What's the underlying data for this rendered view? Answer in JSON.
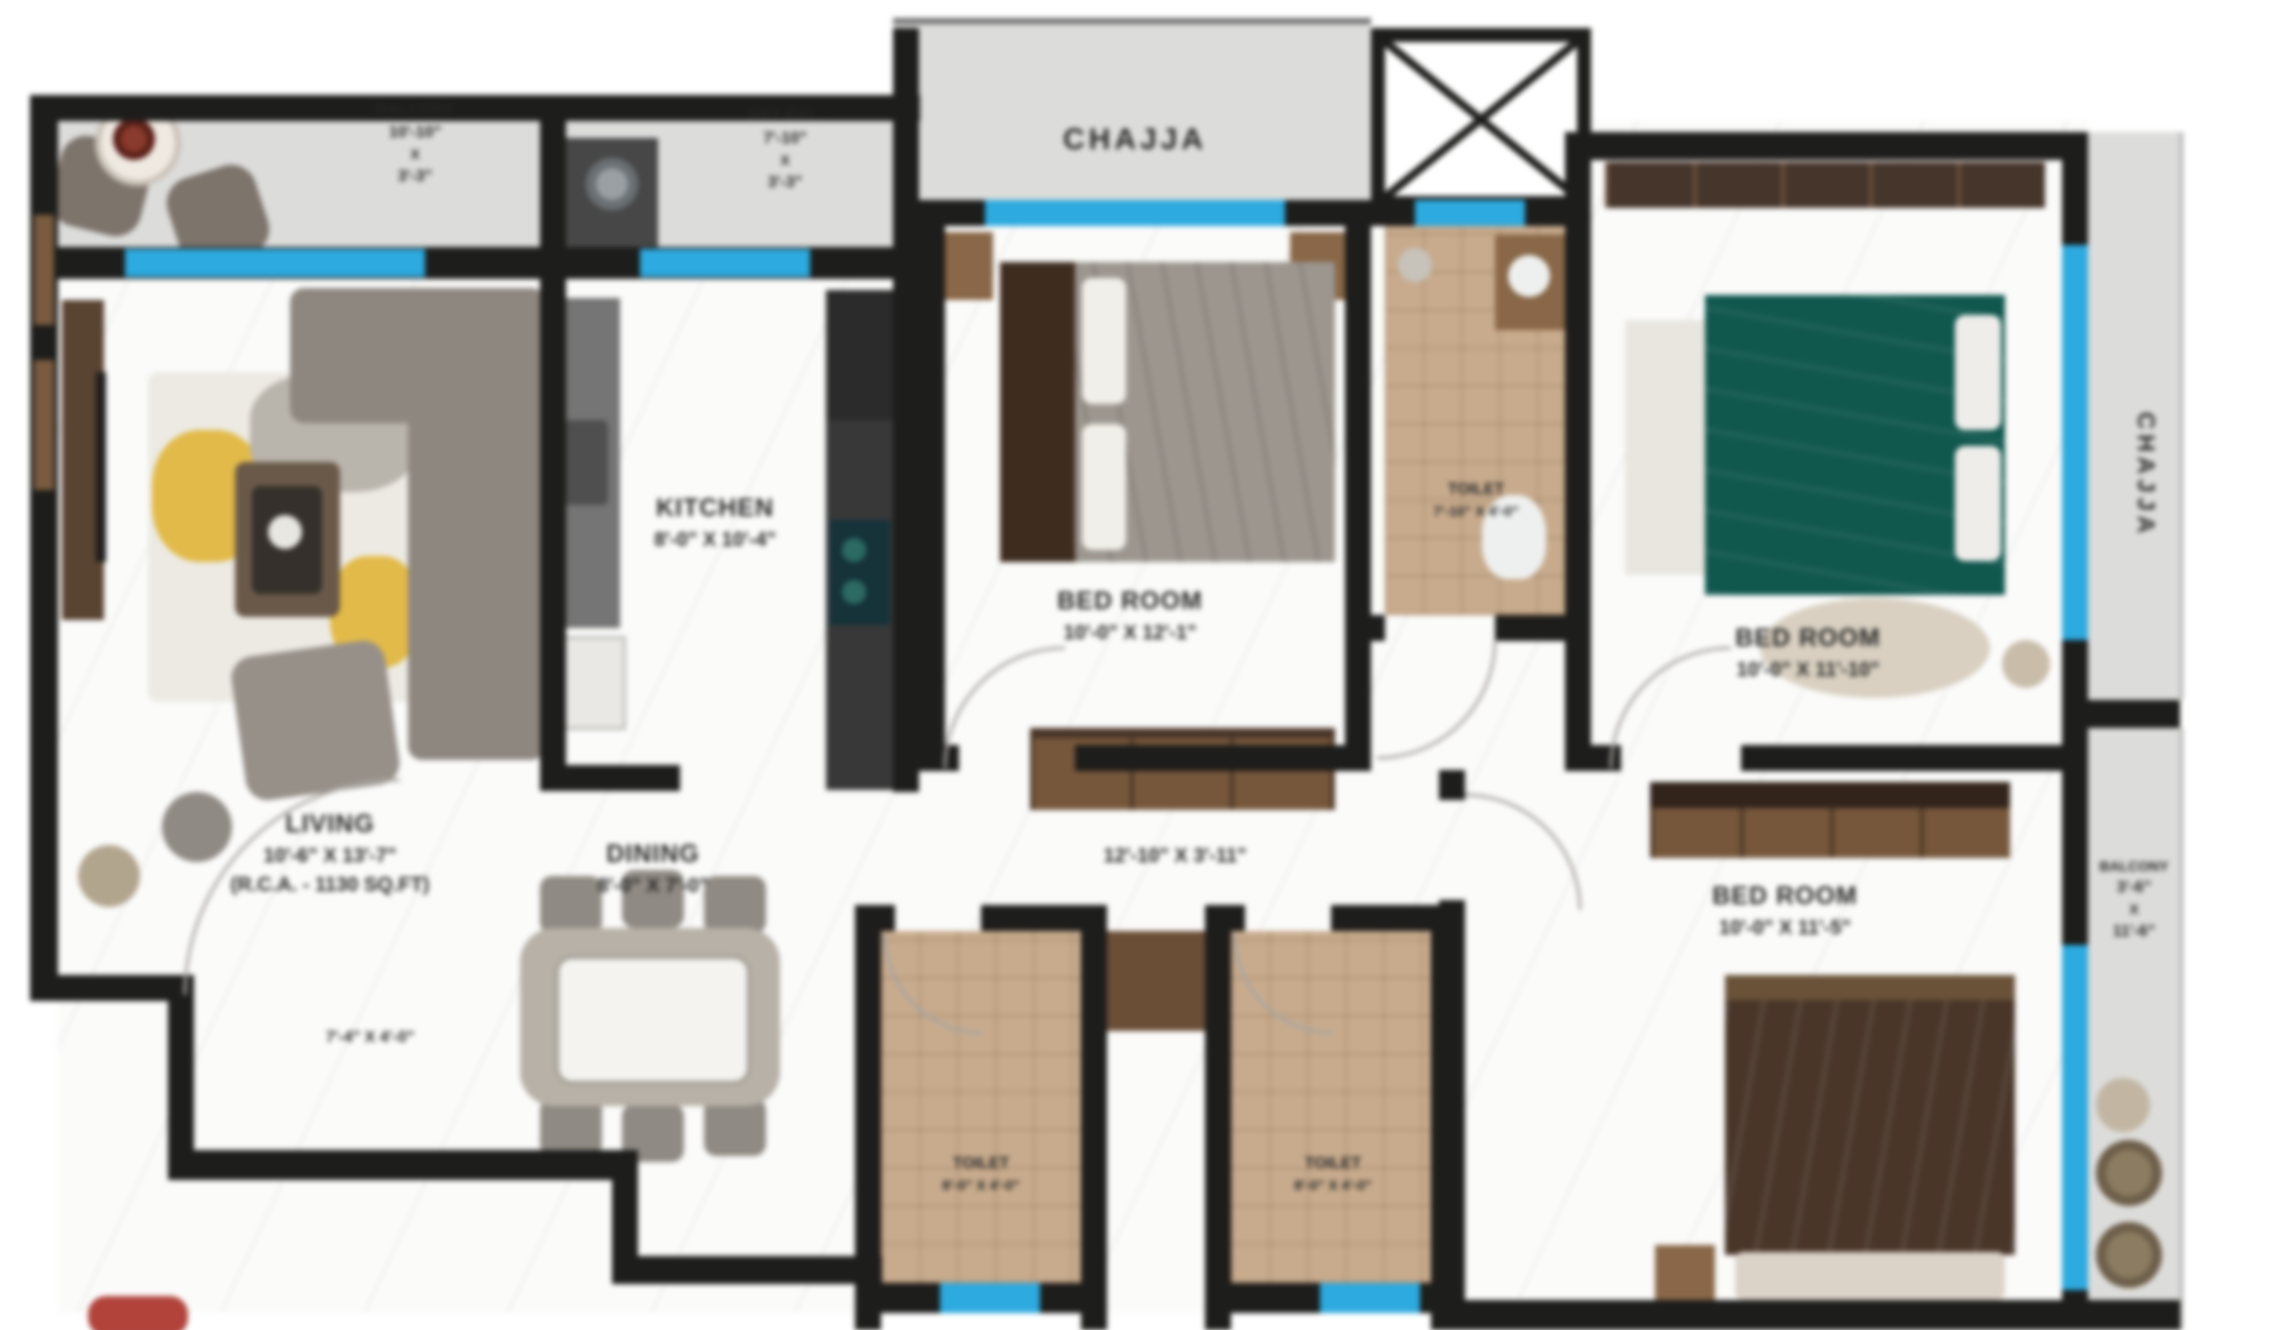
{
  "rooms": {
    "balcony_top": {
      "name": "BALCONY",
      "dim1": "10'-10\"",
      "x": "X",
      "dim2": "3'-3\""
    },
    "dry_bal": {
      "name": "DRY BAL.",
      "dim1": "7'-10\"",
      "x": "X",
      "dim2": "3'-3\""
    },
    "chajja_top": {
      "name": "CHAJJA"
    },
    "chajja_right": {
      "name": "CHAJJA"
    },
    "bedroom_center": {
      "name": "BED ROOM",
      "dims": "10'-0\" X 12'-1\""
    },
    "bedroom_top_right": {
      "name": "BED ROOM",
      "dims": "10'-0\" X 11'-10\""
    },
    "bedroom_bottom_right": {
      "name": "BED ROOM",
      "dims": "10'-0\" X 11'-5\""
    },
    "kitchen": {
      "name": "KITCHEN",
      "dims": "8'-0\" X 10'-4\""
    },
    "living": {
      "name": "LIVING",
      "dims": "10'-6\" X 13'-7\"",
      "area": "(R.C.A. - 1130 SQ.FT)"
    },
    "dining": {
      "name": "DINING",
      "dims": "8'-0\" X 7'-0\""
    },
    "passage": {
      "dims": "12'-10\" X 3'-11\""
    },
    "toilet_common": {
      "name": "TOILET",
      "dims": "7'-10\" X 4'-0\""
    },
    "toilet_1": {
      "name": "TOILET",
      "dims": "8'-0\" X 4'-0\""
    },
    "toilet_2": {
      "name": "TOILET",
      "dims": "8'-0\" X 4'-0\""
    },
    "balcony_right": {
      "name": "BALCONY",
      "dim1": "3'-6\"",
      "x": "X",
      "dim2": "11'-6\""
    },
    "foyer": {
      "dims": "7'-4\" X 4'-0\""
    }
  },
  "colors": {
    "wall": "#1d1d1b",
    "window": "#29abe2",
    "chajja": "#dcdcda",
    "tile": "#c9ab8c",
    "teal_bed": "#0e584e",
    "accent_red": "#b5423a"
  }
}
